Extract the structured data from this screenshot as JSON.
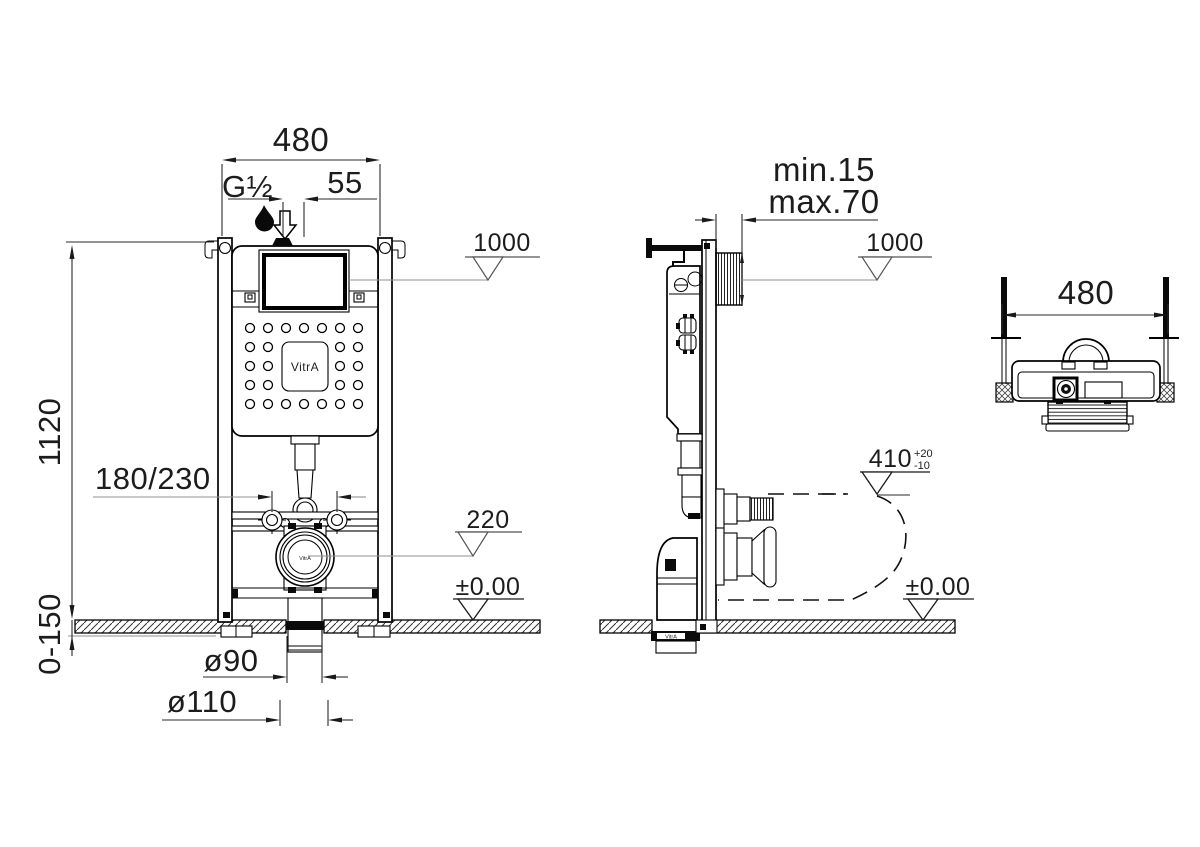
{
  "front_view": {
    "width_dim": "480",
    "inlet_thread": "G½",
    "inlet_offset_dim": "55",
    "panel_level": "1000",
    "height_dim": "1120",
    "fixing_dim": "180/230",
    "outlet_level": "220",
    "floor_level": "±0.00",
    "floor_range_dim": "0-150",
    "drain_inner_dim": "ø90",
    "drain_outer_dim": "ø110",
    "brand": "VitrA",
    "drain_brand": "VitrA"
  },
  "side_view": {
    "wall_gap_min": "min.15",
    "wall_gap_max": "max.70",
    "panel_level": "1000",
    "outlet_height": "410",
    "outlet_tol_plus": "+20",
    "outlet_tol_minus": "-10",
    "floor_level": "±0.00",
    "pipe_brand": "VitrA"
  },
  "top_view": {
    "width_dim": "480"
  }
}
